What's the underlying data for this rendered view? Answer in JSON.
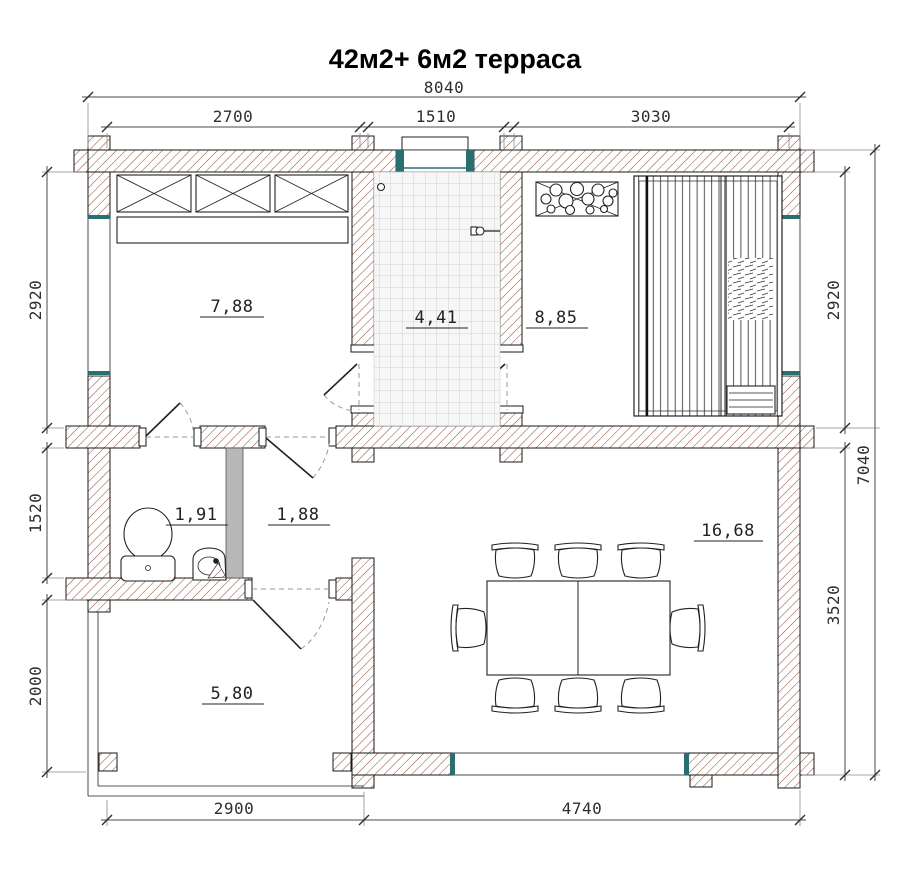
{
  "title": "42м2+ 6м2 терраса",
  "dimensions_mm": {
    "top_total": "8040",
    "top_segments": [
      "2700",
      "1510",
      "3030"
    ],
    "left": [
      "2920",
      "1520",
      "2000"
    ],
    "right": [
      "2920",
      "3520"
    ],
    "right_total": "7040",
    "bottom": [
      "2900",
      "4740"
    ]
  },
  "room_areas_m2": {
    "bedroom": "7,88",
    "shower_room": "4,41",
    "sauna": "8,85",
    "wc": "1,91",
    "hall": "1,88",
    "living_room": "16,68",
    "terrace": "5,80"
  },
  "colors": {
    "wall_hatch": "#8d4a2e",
    "joinery_teal": "#2a6f6f",
    "partition_gray": "#b8b8b8",
    "dimension_text": "#2e2e2e"
  }
}
